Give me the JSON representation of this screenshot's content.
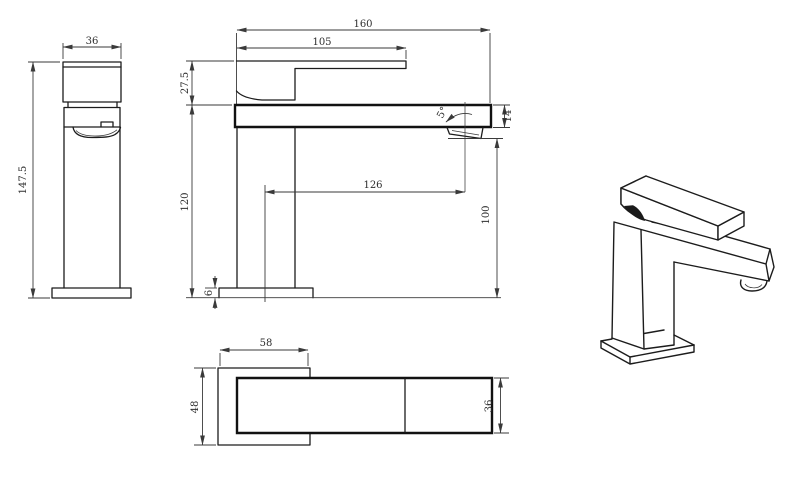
{
  "drawing": {
    "title": "Square single-lever basin mixer tap — dimensioned technical drawing",
    "views": {
      "front": "front elevation",
      "side": "side elevation",
      "plan": "plan (top) view",
      "perspective": "3D perspective view"
    },
    "dims": {
      "front_width": "36",
      "front_height": "147.5",
      "side_overall_length": "160",
      "side_handle_length": "105",
      "side_handle_height": "27.5",
      "side_body_height": "120",
      "side_base_thickness": "6",
      "side_spout_reach": "126",
      "side_spout_clearance": "100",
      "side_spout_tip_height": "14",
      "side_spout_angle": "5°",
      "plan_base_width": "58",
      "plan_base_depth": "48",
      "plan_spout_width": "36"
    },
    "colors": {
      "line": "#1c1c1c",
      "background": "#ffffff",
      "text": "#2e2e2e"
    }
  }
}
